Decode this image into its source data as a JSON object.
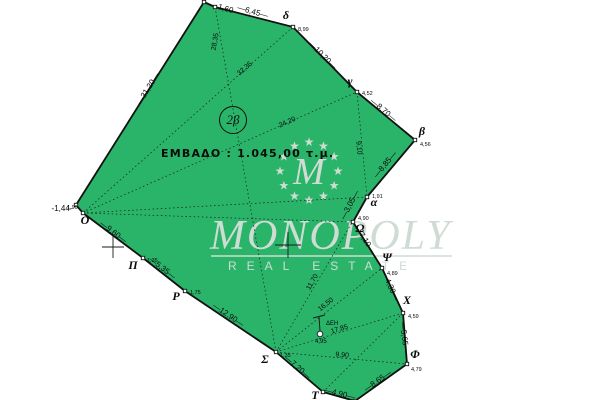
{
  "title": "Topographic parcel plan",
  "colors": {
    "parcel_fill": "#2ab469",
    "boundary": "#111111",
    "linework": "#1a1a1a",
    "watermark": "#cfdcd4",
    "marker_fill": "#ffffff",
    "text": "#0b0b0b"
  },
  "parcel": {
    "id_label": "2β",
    "area_label": "ΕΜΒΑΔΟ : 1.045,00 τ.μ.",
    "boundary": [
      [
        204,
        2
      ],
      [
        215,
        7
      ],
      [
        293,
        27
      ],
      [
        357,
        92
      ],
      [
        415,
        140
      ],
      [
        367,
        197
      ],
      [
        353,
        222
      ],
      [
        382,
        268
      ],
      [
        403,
        313
      ],
      [
        407,
        364
      ],
      [
        355,
        401
      ],
      [
        323,
        392
      ],
      [
        276,
        352
      ],
      [
        185,
        291
      ],
      [
        143,
        258
      ],
      [
        83,
        213
      ],
      [
        76,
        205
      ]
    ],
    "vertices": [
      {
        "letter": "δ",
        "x": 293,
        "y": 27,
        "ldx": -7,
        "ldy": -8,
        "num": "8,99",
        "ndx": 5,
        "ndy": 4
      },
      {
        "letter": "γ",
        "x": 357,
        "y": 92,
        "ldx": -7,
        "ldy": -7,
        "num": "4,52",
        "ndx": 5,
        "ndy": 3
      },
      {
        "letter": "β",
        "x": 415,
        "y": 140,
        "ldx": 7,
        "ldy": -5,
        "num": "4,56",
        "ndx": 5,
        "ndy": 6
      },
      {
        "letter": "α",
        "x": 367,
        "y": 197,
        "ldx": 7,
        "ldy": 9,
        "num": "1,91",
        "ndx": 5,
        "ndy": 1
      },
      {
        "letter": "Ω",
        "x": 353,
        "y": 222,
        "ldx": 7,
        "ldy": 10,
        "num": "4,90",
        "ndx": 5,
        "ndy": -2
      },
      {
        "letter": "Ψ",
        "x": 382,
        "y": 268,
        "ldx": 5,
        "ldy": -7,
        "num": "4,89",
        "ndx": 5,
        "ndy": 7
      },
      {
        "letter": "Χ",
        "x": 403,
        "y": 313,
        "ldx": 4,
        "ldy": -9,
        "num": "4,59",
        "ndx": 5,
        "ndy": 5
      },
      {
        "letter": "Φ",
        "x": 407,
        "y": 364,
        "ldx": 8,
        "ldy": -6,
        "num": "4,79",
        "ndx": 4,
        "ndy": 7
      },
      {
        "letter": "Τ",
        "x": 323,
        "y": 392,
        "ldx": -8,
        "ldy": 7,
        "num": "",
        "ndx": 0,
        "ndy": 0
      },
      {
        "letter": "Σ",
        "x": 276,
        "y": 352,
        "ldx": -11,
        "ldy": 11,
        "num": "1,35",
        "ndx": 4,
        "ndy": 5
      },
      {
        "letter": "Ρ",
        "x": 185,
        "y": 291,
        "ldx": -9,
        "ldy": 9,
        "num": "1,75",
        "ndx": 5,
        "ndy": 3
      },
      {
        "letter": "Π",
        "x": 143,
        "y": 258,
        "ldx": -10,
        "ldy": 11,
        "num": "1,35",
        "ndx": 4,
        "ndy": 4
      },
      {
        "letter": "Ο",
        "x": 83,
        "y": 213,
        "ldx": 2,
        "ldy": 11,
        "num": "1,90",
        "ndx": -16,
        "ndy": -4
      }
    ],
    "edge_labels": [
      {
        "text": "1,60",
        "x": 225,
        "y": 11,
        "rot": 16
      },
      {
        "text": "—6,45—",
        "x": 252,
        "y": 14,
        "rot": 16
      },
      {
        "text": "—10,20—",
        "x": 321,
        "y": 57,
        "rot": 45
      },
      {
        "text": "—8,70—",
        "x": 382,
        "y": 112,
        "rot": 40
      },
      {
        "text": "—8,85—",
        "x": 387,
        "y": 166,
        "rot": -50
      },
      {
        "text": "—3,05—",
        "x": 352,
        "y": 206,
        "rot": -62
      },
      {
        "text": "—7,10—",
        "x": 363,
        "y": 241,
        "rot": 57
      },
      {
        "text": "—4,30—",
        "x": 388,
        "y": 287,
        "rot": 66
      },
      {
        "text": "—5,65—",
        "x": 402,
        "y": 338,
        "rot": 83
      },
      {
        "text": "—8,65—",
        "x": 379,
        "y": 383,
        "rot": -35
      },
      {
        "text": "—4,90—",
        "x": 339,
        "y": 396,
        "rot": 14
      },
      {
        "text": "—7,20—",
        "x": 296,
        "y": 369,
        "rot": 41
      },
      {
        "text": "—12,90—",
        "x": 227,
        "y": 317,
        "rot": 34
      },
      {
        "text": "—5,35—",
        "x": 161,
        "y": 270,
        "rot": 38
      },
      {
        "text": "—9,60—",
        "x": 112,
        "y": 234,
        "rot": 37
      },
      {
        "text": "-1,44-",
        "x": 62,
        "y": 211,
        "rot": 0
      },
      {
        "text": "—31,20—",
        "x": 150,
        "y": 90,
        "rot": -58
      }
    ],
    "diagonals": [
      {
        "x1": 83,
        "y1": 213,
        "x2": 293,
        "y2": 27,
        "label": "32,35",
        "lx": 246,
        "ly": 70,
        "rot": -41
      },
      {
        "x1": 83,
        "y1": 213,
        "x2": 357,
        "y2": 92,
        "label": "24,20",
        "lx": 288,
        "ly": 124,
        "rot": -24
      },
      {
        "x1": 83,
        "y1": 213,
        "x2": 367,
        "y2": 197,
        "label": "",
        "lx": 0,
        "ly": 0,
        "rot": 0
      },
      {
        "x1": 83,
        "y1": 213,
        "x2": 353,
        "y2": 222,
        "label": "",
        "lx": 0,
        "ly": 0,
        "rot": 0
      },
      {
        "x1": 276,
        "y1": 352,
        "x2": 215,
        "y2": 7,
        "label": "28,35",
        "lx": 217,
        "ly": 42,
        "rot": -80
      },
      {
        "x1": 276,
        "y1": 352,
        "x2": 367,
        "y2": 197,
        "label": "11,70",
        "lx": 314,
        "ly": 283,
        "rot": -60
      },
      {
        "x1": 276,
        "y1": 352,
        "x2": 382,
        "y2": 268,
        "label": "16,50",
        "lx": 327,
        "ly": 306,
        "rot": -39
      },
      {
        "x1": 276,
        "y1": 352,
        "x2": 403,
        "y2": 313,
        "label": "17,85",
        "lx": 340,
        "ly": 331,
        "rot": -17
      },
      {
        "x1": 276,
        "y1": 352,
        "x2": 407,
        "y2": 364,
        "label": "9,90",
        "lx": 342,
        "ly": 357,
        "rot": 5
      },
      {
        "x1": 357,
        "y1": 92,
        "x2": 367,
        "y2": 197,
        "label": "9,10",
        "lx": 357,
        "ly": 148,
        "rot": 85
      },
      {
        "x1": 323,
        "y1": 392,
        "x2": 403,
        "y2": 313,
        "label": "",
        "lx": 0,
        "ly": 0,
        "rot": 0
      }
    ],
    "crosses": [
      {
        "x": 113,
        "y": 247,
        "s": 11
      },
      {
        "x": 288,
        "y": 245,
        "s": 13
      }
    ],
    "pole": {
      "label": "ΔΕΗ",
      "num": "4,95",
      "x": 319,
      "y": 317,
      "cy": 334
    }
  },
  "watermark": {
    "brand": "MONOPOLY",
    "subtitle": "REAL ESTATE",
    "monogram": "M",
    "star_char": "★",
    "stars": {
      "count": 12,
      "cx": 309,
      "cy": 171,
      "r": 29
    }
  }
}
